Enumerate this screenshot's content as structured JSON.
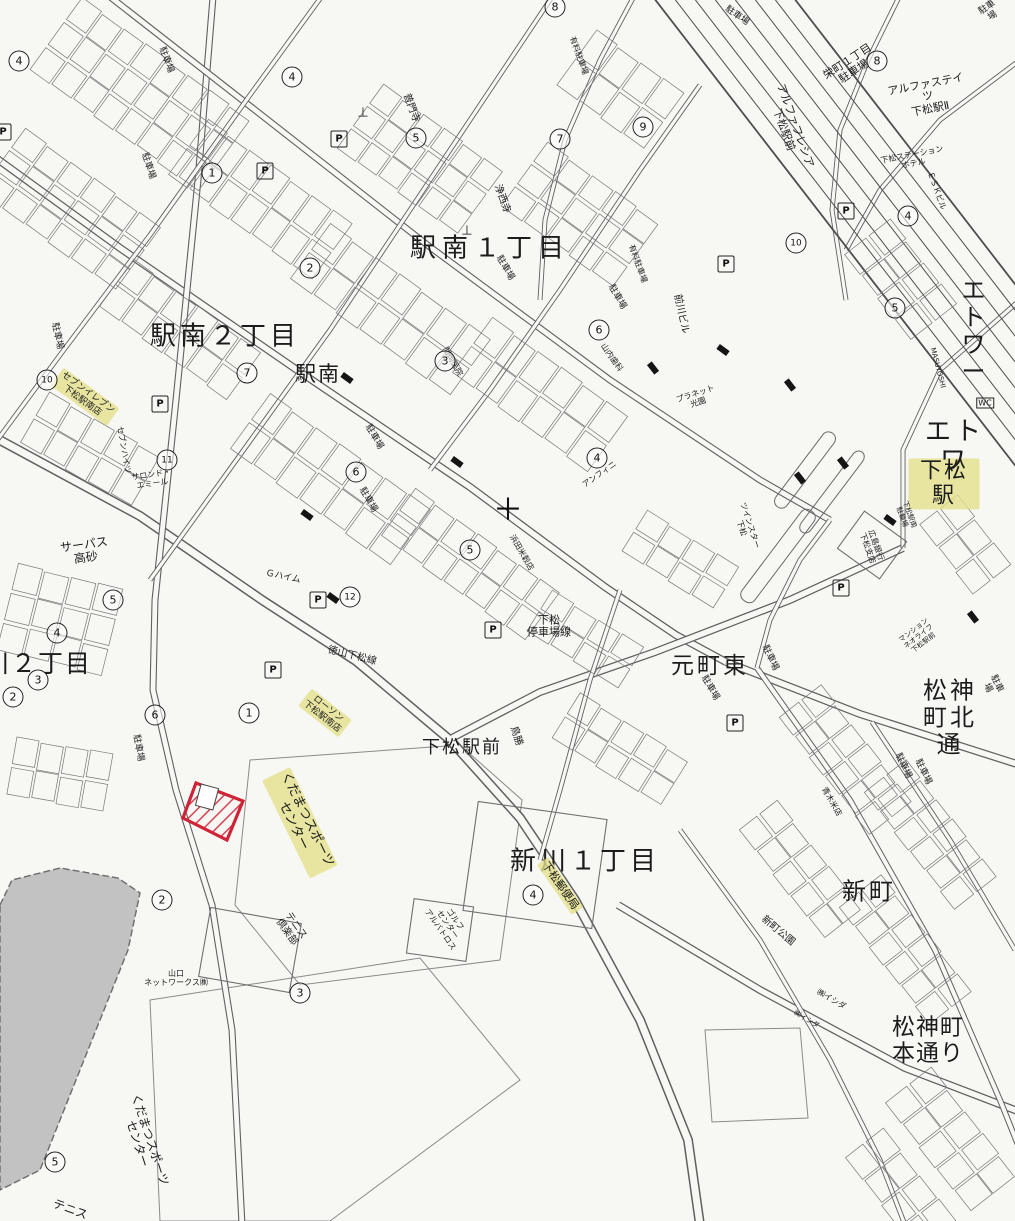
{
  "colors": {
    "paper": "#f7f7f3",
    "line": "#5f5f5f",
    "highlight_yellow": "#e4e08c",
    "parcel_red": "#cf2438",
    "gray_zone": "#c2c2c2"
  },
  "map": {
    "area_labels": [
      {
        "name": "area-ekiminami-1chome",
        "text": "駅南１丁目",
        "x": 490,
        "y": 249,
        "size": 26,
        "rot": 0,
        "ls": 6
      },
      {
        "name": "area-ekiminami-2chome",
        "text": "駅南２丁目",
        "x": 225,
        "y": 337,
        "size": 26,
        "rot": 0,
        "ls": 4
      },
      {
        "name": "area-ekiminami",
        "text": "駅南",
        "x": 318,
        "y": 375,
        "size": 21,
        "rot": 0,
        "ls": 2
      },
      {
        "name": "station-kudamatsu",
        "text": "下松駅",
        "x": 944,
        "y": 484,
        "size": 22,
        "rot": 0,
        "ls": 2,
        "hl": true
      },
      {
        "name": "area-etoile-upper",
        "text": "エトワー",
        "x": 975,
        "y": 331,
        "size": 24,
        "rot": 0,
        "ls": 3
      },
      {
        "name": "area-etoile-lower",
        "text": "エトワ",
        "x": 955,
        "y": 447,
        "size": 26,
        "rot": 0,
        "ls": 4
      },
      {
        "name": "area-motomachi-higashi",
        "text": "元町東",
        "x": 710,
        "y": 667,
        "size": 23,
        "rot": 0,
        "ls": 3
      },
      {
        "name": "area-matsukamicho-kitadori",
        "text": "松神町北通",
        "x": 950,
        "y": 718,
        "size": 24,
        "rot": 0,
        "ls": 3
      },
      {
        "name": "area-shinkawa-1chome",
        "text": "新川１丁目",
        "x": 585,
        "y": 862,
        "size": 26,
        "rot": 0,
        "ls": 4
      },
      {
        "name": "area-shinmachi",
        "text": "新町",
        "x": 869,
        "y": 892,
        "size": 24,
        "rot": 0,
        "ls": 3
      },
      {
        "name": "area-matsukamicho-hondori",
        "text": "松神町本通り",
        "x": 928,
        "y": 1041,
        "size": 23,
        "rot": 0,
        "ls": 1
      },
      {
        "name": "area-kawa-2chome",
        "text": "川２丁目",
        "x": 38,
        "y": 664,
        "size": 25,
        "rot": 0,
        "ls": 2
      },
      {
        "name": "area-kudamatsu-ekimae",
        "text": "下松駅前",
        "x": 462,
        "y": 748,
        "size": 18,
        "rot": 0,
        "ls": 2
      }
    ],
    "place_labels": [
      {
        "name": "road-teishajo-line",
        "text": "下松\n停車場線",
        "x": 549,
        "y": 627,
        "size": 11,
        "rot": 0
      },
      {
        "name": "road-tokuyama-kudamatsu-line",
        "text": "徳山下松線",
        "x": 352,
        "y": 656,
        "size": 10,
        "rot": 14
      },
      {
        "name": "surpass-takasago",
        "text": "サーパス\n高砂",
        "x": 85,
        "y": 552,
        "size": 12,
        "rot": -8
      },
      {
        "name": "sports-center-upper",
        "text": "くだまつスポーツ\nセンター",
        "x": 300,
        "y": 823,
        "size": 13,
        "rot": 64,
        "hl": true
      },
      {
        "name": "sports-center-lower",
        "text": "くだまつスポーツ\nセンター",
        "x": 143,
        "y": 1142,
        "size": 12,
        "rot": 72
      },
      {
        "name": "tennis-club",
        "text": "テニス\n倶楽部",
        "x": 291,
        "y": 929,
        "size": 10,
        "rot": 55
      },
      {
        "name": "tennis",
        "text": "テニス",
        "x": 70,
        "y": 1210,
        "size": 12,
        "rot": 20
      },
      {
        "name": "seven-eleven-kudamatsu-ekinan",
        "text": "セブンイレブン\n下松駅南店",
        "x": 85,
        "y": 397,
        "size": 9,
        "rot": 36,
        "hl": true
      },
      {
        "name": "lawson-kudamatsu-ekinan",
        "text": "ローソン\n下松駅南店",
        "x": 325,
        "y": 713,
        "size": 9,
        "rot": 38,
        "hl": true
      },
      {
        "name": "kudamatsu-post-office",
        "text": "下松郵便局",
        "x": 560,
        "y": 886,
        "size": 11,
        "rot": 55,
        "hl": true
      },
      {
        "name": "alpha-states-kudamatsu-2",
        "text": "アルファステイツ\n下松駅Ⅱ",
        "x": 928,
        "y": 97,
        "size": 11,
        "rot": -11
      },
      {
        "name": "alpha-frecia-ekimae",
        "text": "アルファフレシア\n下松駅前",
        "x": 789,
        "y": 128,
        "size": 11,
        "rot": 70
      },
      {
        "name": "sakaemachi-1chome-parking",
        "text": "栄町１丁目\n駐車場",
        "x": 851,
        "y": 67,
        "size": 11,
        "rot": -33
      },
      {
        "name": "kudamatsu-station-hotel",
        "text": "下松ステーション\nホテル",
        "x": 913,
        "y": 160,
        "size": 8,
        "rot": -11
      },
      {
        "name": "esk-building",
        "text": "ＥＳＫビル",
        "x": 936,
        "y": 191,
        "size": 8,
        "rot": 70
      },
      {
        "name": "fumonji-temple",
        "text": "普門寺",
        "x": 411,
        "y": 108,
        "size": 10,
        "rot": 70
      },
      {
        "name": "joseiji-temple",
        "text": "浄西寺",
        "x": 502,
        "y": 199,
        "size": 10,
        "rot": 70
      },
      {
        "name": "hiroshima-bank-kudamatsu",
        "text": "広島銀行\n下松支店",
        "x": 871,
        "y": 547,
        "size": 8,
        "rot": 70
      },
      {
        "name": "yamauchi-dental",
        "text": "山内歯科",
        "x": 611,
        "y": 358,
        "size": 8,
        "rot": 55
      },
      {
        "name": "maekawa-building",
        "text": "前川ビル",
        "x": 681,
        "y": 314,
        "size": 10,
        "rot": 78
      },
      {
        "name": "planet-koen",
        "text": "プラネット\n光園",
        "x": 697,
        "y": 399,
        "size": 8,
        "rot": -18
      },
      {
        "name": "yamaguchi-networks",
        "text": "山口\nネットワークス㈱",
        "x": 176,
        "y": 979,
        "size": 8,
        "rot": 0
      },
      {
        "name": "torikatsu",
        "text": "鳥勝",
        "x": 516,
        "y": 736,
        "size": 10,
        "rot": 72
      },
      {
        "name": "twin-star-kudamatsu",
        "text": "ツインスター\n下松",
        "x": 745,
        "y": 527,
        "size": 8,
        "rot": 72
      },
      {
        "name": "mansion-neo-life",
        "text": "マンション\nネオライフ\n下松駅前",
        "x": 919,
        "y": 637,
        "size": 7,
        "rot": -38
      },
      {
        "name": "aoki-rice-store",
        "text": "青木米店",
        "x": 831,
        "y": 802,
        "size": 8,
        "rot": 60
      },
      {
        "name": "ishida-co-1",
        "text": "㈱イシダ",
        "x": 831,
        "y": 1000,
        "size": 8,
        "rot": 30
      },
      {
        "name": "ishida-co-2",
        "text": "㈱イシダ",
        "x": 806,
        "y": 1020,
        "size": 7,
        "rot": 30
      },
      {
        "name": "shinmachi-park",
        "text": "新町公園",
        "x": 778,
        "y": 931,
        "size": 10,
        "rot": 40
      },
      {
        "name": "station-south-bicycle-parking",
        "text": "下松駅南\n駐輪場",
        "x": 905,
        "y": 516,
        "size": 7,
        "rot": 70
      },
      {
        "name": "masuyoshi",
        "text": "MASUYOSHI",
        "x": 937,
        "y": 368,
        "size": 7,
        "rot": 75
      },
      {
        "name": "hamada-rice",
        "text": "浜田米穀店",
        "x": 521,
        "y": 553,
        "size": 8,
        "rot": 60
      },
      {
        "name": "sekioka-clinic",
        "text": "関岡医院",
        "x": 452,
        "y": 362,
        "size": 8,
        "rot": 60
      },
      {
        "name": "paid-parking-1",
        "text": "有料駐車場",
        "x": 637,
        "y": 264,
        "size": 8,
        "rot": 70
      },
      {
        "name": "paid-parking-2",
        "text": "有料駐車場",
        "x": 578,
        "y": 56,
        "size": 8,
        "rot": 70
      },
      {
        "name": "golf-center-albatross",
        "text": "ゴルフ\nセンター\nアルバトロス",
        "x": 447,
        "y": 925,
        "size": 8,
        "rot": 55
      },
      {
        "name": "anfini",
        "text": "アンフィニ",
        "x": 600,
        "y": 475,
        "size": 8,
        "rot": -35
      },
      {
        "name": "g-heim",
        "text": "Ｇハイム",
        "x": 283,
        "y": 577,
        "size": 9,
        "rot": 12
      },
      {
        "name": "salon-de-emile",
        "text": "サロンド・\nエミール",
        "x": 152,
        "y": 480,
        "size": 8,
        "rot": -8
      },
      {
        "name": "seven-heights",
        "text": "セブンハイツ",
        "x": 123,
        "y": 450,
        "size": 8,
        "rot": 80
      }
    ],
    "parking_text": "駐車場",
    "parking_labels": [
      {
        "x": 737,
        "y": 16,
        "rot": 35
      },
      {
        "x": 990,
        "y": 12,
        "rot": -33
      },
      {
        "x": 148,
        "y": 166,
        "rot": 72
      },
      {
        "x": 166,
        "y": 60,
        "rot": 70
      },
      {
        "x": 57,
        "y": 336,
        "rot": 78
      },
      {
        "x": 374,
        "y": 437,
        "rot": 60
      },
      {
        "x": 368,
        "y": 500,
        "rot": 60
      },
      {
        "x": 505,
        "y": 268,
        "rot": 60
      },
      {
        "x": 617,
        "y": 297,
        "rot": 60
      },
      {
        "x": 770,
        "y": 658,
        "rot": 65
      },
      {
        "x": 903,
        "y": 766,
        "rot": 65
      },
      {
        "x": 923,
        "y": 772,
        "rot": 65
      },
      {
        "x": 992,
        "y": 686,
        "rot": 65
      },
      {
        "x": 138,
        "y": 748,
        "rot": 80
      },
      {
        "x": 710,
        "y": 688,
        "rot": 60
      }
    ],
    "circled_numbers": [
      {
        "v": "4",
        "x": 19,
        "y": 61
      },
      {
        "v": "1",
        "x": 212,
        "y": 173
      },
      {
        "v": "4",
        "x": 292,
        "y": 77
      },
      {
        "v": "5",
        "x": 416,
        "y": 138
      },
      {
        "v": "8",
        "x": 555,
        "y": 7
      },
      {
        "v": "9",
        "x": 643,
        "y": 127
      },
      {
        "v": "7",
        "x": 560,
        "y": 139
      },
      {
        "v": "8",
        "x": 877,
        "y": 61
      },
      {
        "v": "4",
        "x": 908,
        "y": 216
      },
      {
        "v": "10",
        "x": 796,
        "y": 243
      },
      {
        "v": "5",
        "x": 895,
        "y": 308
      },
      {
        "v": "2",
        "x": 310,
        "y": 268
      },
      {
        "v": "7",
        "x": 247,
        "y": 373
      },
      {
        "v": "3",
        "x": 445,
        "y": 361
      },
      {
        "v": "6",
        "x": 356,
        "y": 472
      },
      {
        "v": "6",
        "x": 599,
        "y": 330
      },
      {
        "v": "4",
        "x": 597,
        "y": 458
      },
      {
        "v": "5",
        "x": 470,
        "y": 550
      },
      {
        "v": "12",
        "x": 350,
        "y": 597
      },
      {
        "v": "11",
        "x": 167,
        "y": 460
      },
      {
        "v": "10",
        "x": 47,
        "y": 380
      },
      {
        "v": "5",
        "x": 113,
        "y": 600
      },
      {
        "v": "4",
        "x": 57,
        "y": 633
      },
      {
        "v": "3",
        "x": 38,
        "y": 680
      },
      {
        "v": "2",
        "x": 13,
        "y": 697
      },
      {
        "v": "6",
        "x": 155,
        "y": 715
      },
      {
        "v": "1",
        "x": 249,
        "y": 713
      },
      {
        "v": "2",
        "x": 162,
        "y": 900
      },
      {
        "v": "3",
        "x": 300,
        "y": 993
      },
      {
        "v": "4",
        "x": 533,
        "y": 895
      },
      {
        "v": "5",
        "x": 55,
        "y": 1162
      }
    ],
    "parking_symbol_glyph": "P",
    "parking_symbols": [
      {
        "x": 3,
        "y": 132
      },
      {
        "x": 265,
        "y": 171
      },
      {
        "x": 846,
        "y": 211
      },
      {
        "x": 726,
        "y": 264
      },
      {
        "x": 160,
        "y": 404
      },
      {
        "x": 339,
        "y": 139
      },
      {
        "x": 318,
        "y": 600
      },
      {
        "x": 273,
        "y": 670
      },
      {
        "x": 493,
        "y": 630
      },
      {
        "x": 841,
        "y": 588
      },
      {
        "x": 735,
        "y": 723
      }
    ],
    "symbols": [
      {
        "name": "intersection-cross-mark",
        "glyph": "＋",
        "x": 508,
        "y": 507,
        "size": 30
      },
      {
        "name": "cemetery-mark",
        "glyph": "⊥",
        "x": 363,
        "y": 113,
        "size": 13
      },
      {
        "name": "cemetery-mark",
        "glyph": "⊥",
        "x": 467,
        "y": 231,
        "size": 13
      },
      {
        "name": "wc-mark",
        "glyph": "WC",
        "x": 985,
        "y": 403,
        "size": 8
      }
    ]
  }
}
